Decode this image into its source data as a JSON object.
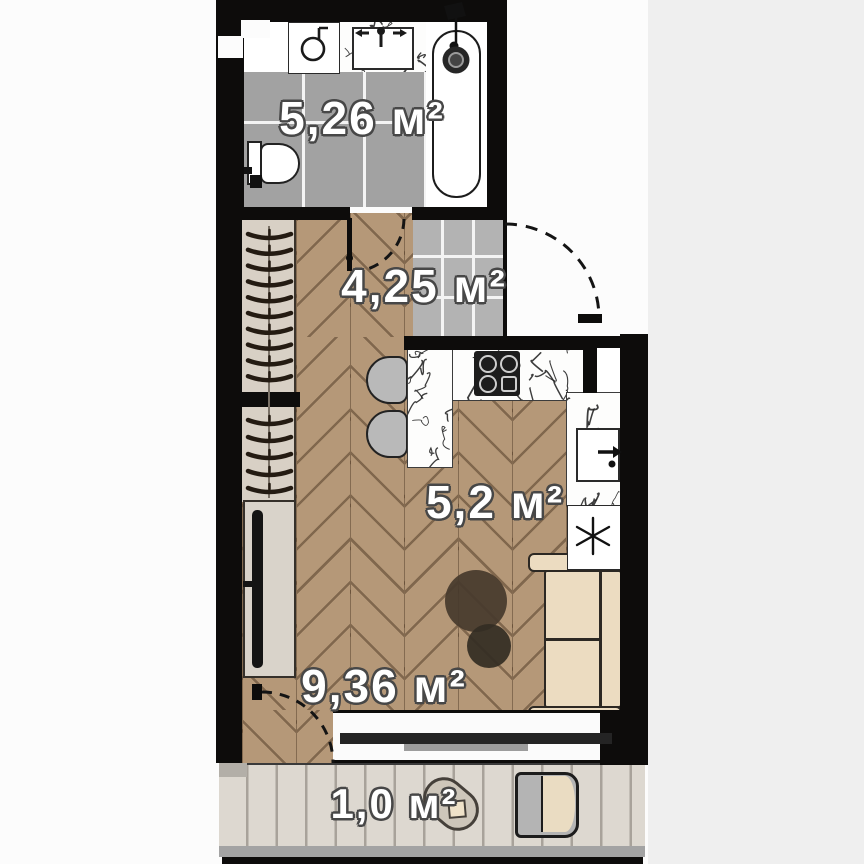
{
  "rooms": {
    "bathroom": {
      "area_label": "5,26 м²"
    },
    "hallway": {
      "area_label": "4,25 м²"
    },
    "kitchen": {
      "area_label": "5,2 м²"
    },
    "living_room": {
      "area_label": "9,36 м²"
    },
    "balcony": {
      "area_label": "1,0 м²"
    }
  },
  "fixtures": [
    "washing-machine-icon",
    "bathroom-sink-icon",
    "bathtub-icon",
    "toilet-icon",
    "wardrobe-hangers-icon",
    "bathroom-door-swing",
    "entrance-door-swing",
    "cooktop-icon",
    "kitchen-sink-icon",
    "refrigerator-snowflake-icon",
    "bar-table",
    "stool",
    "tv-console",
    "sofa",
    "coffee-tables",
    "window",
    "balcony-door-swing",
    "balcony-table",
    "balcony-chair"
  ],
  "colors": {
    "wall": "#0d0c0b",
    "wood_floor": "#b59878",
    "bathroom_tile": "#a2a2a2",
    "hallway_tile": "#b3b3b3",
    "wardrobe": "#d8d0c5",
    "sofa": "#ecdcc1",
    "deck": "#ddd8d0",
    "label_fill": "#ffffff",
    "label_outline": "#474747"
  }
}
